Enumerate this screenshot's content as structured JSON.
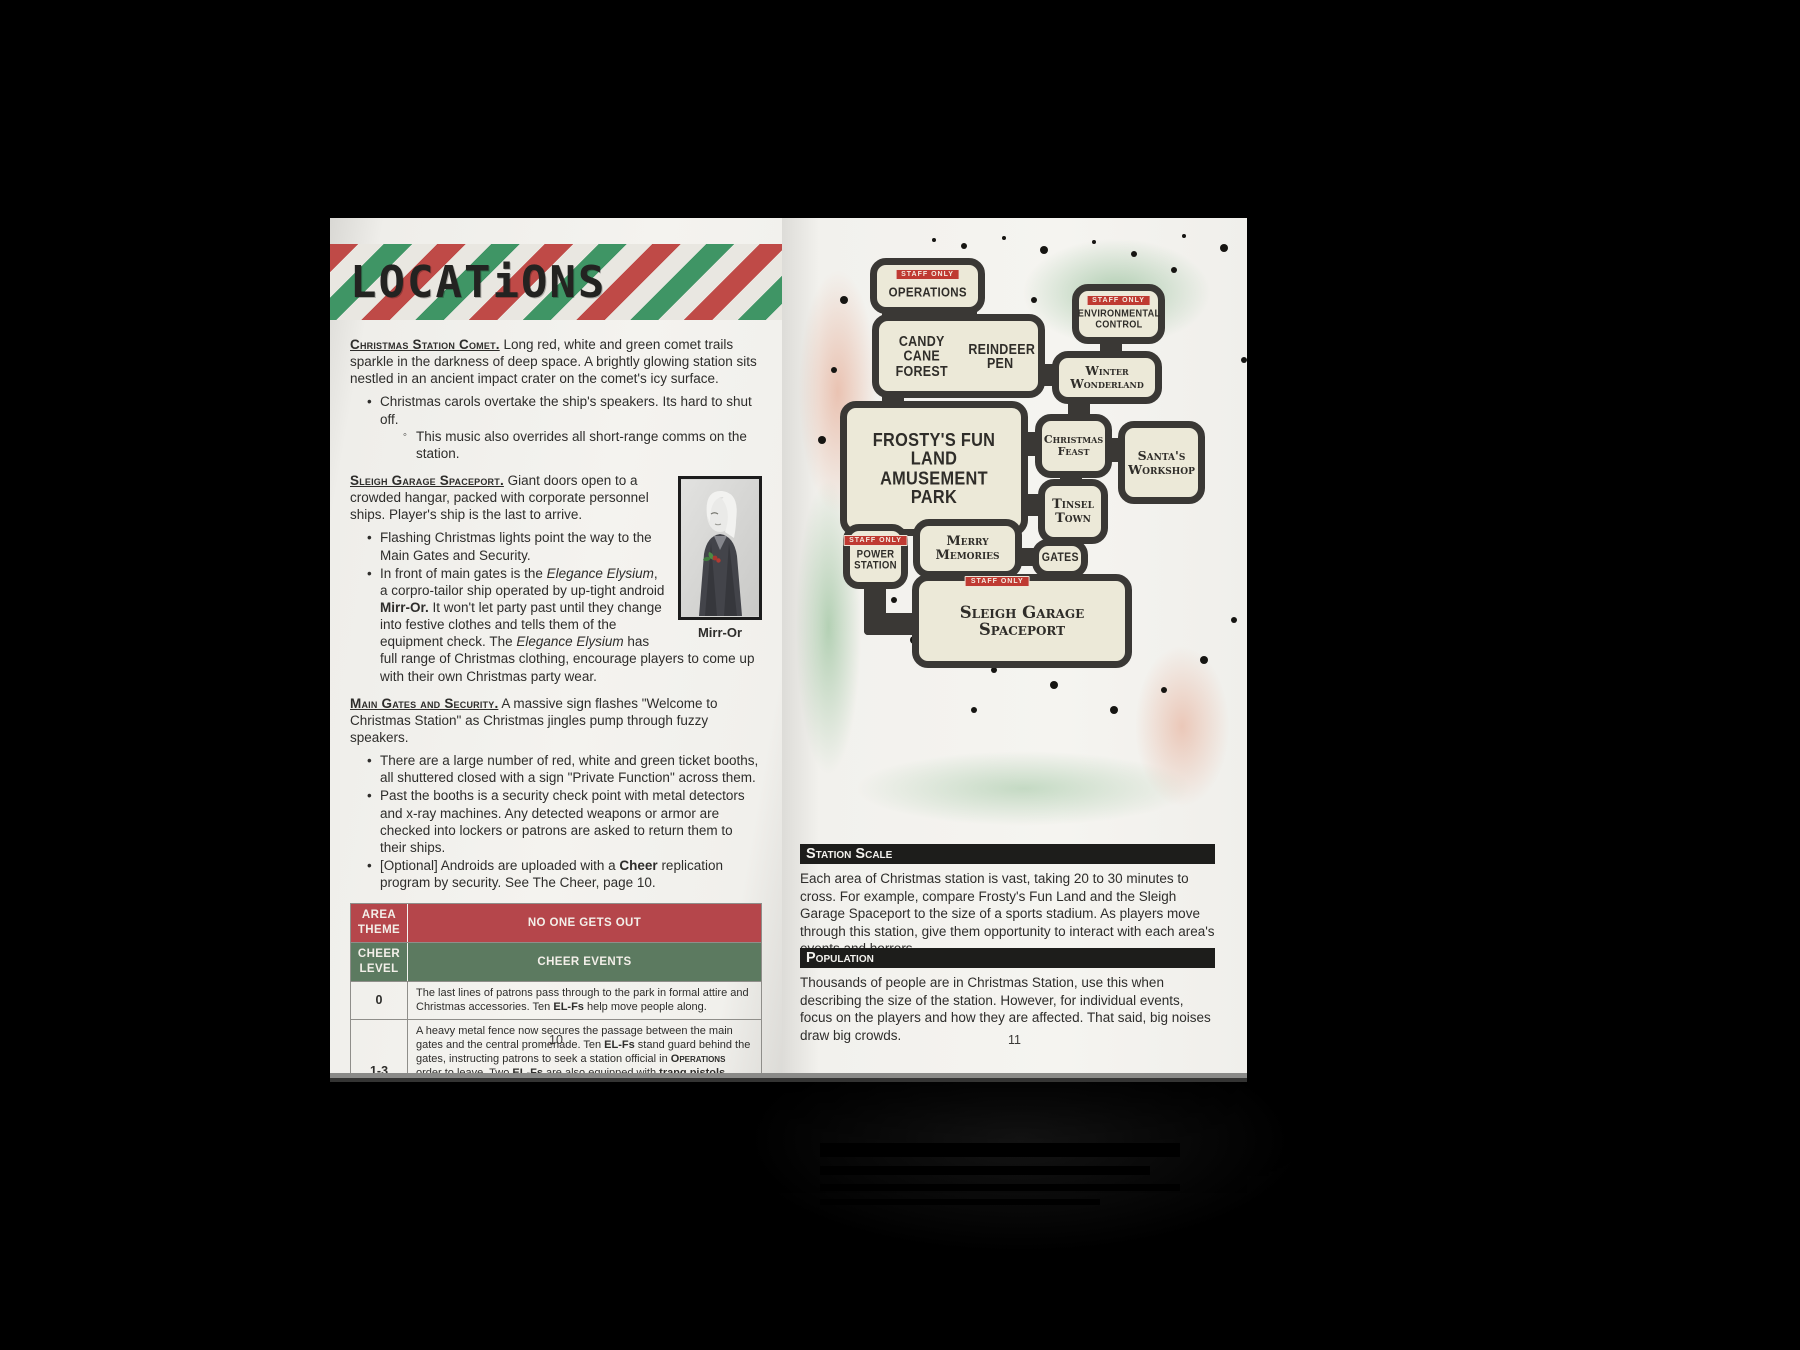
{
  "book": {
    "left_page": {
      "page_number": "10",
      "header_title": "LOCATiONS",
      "comet": {
        "title": "Christmas Station Comet.",
        "lead": " Long red, white and green comet trails sparkle in the darkness of deep space.  A brightly glowing station sits nestled in an ancient impact crater on the comet's icy surface.",
        "bullet1": "Christmas carols overtake the ship's speakers. Its hard to shut off.",
        "sub1": "This music also overrides all short-range comms on the station."
      },
      "spaceport": {
        "title": "Sleigh Garage Spaceport.",
        "lead": " Giant doors open to a crowded hangar, packed with corporate personnel ships. Player's ship is the last to arrive.",
        "bullet1": "Flashing Christmas lights point the way to the Main Gates and Security.",
        "bullet2_segments": [
          {
            "t": "In front of main gates is the "
          },
          {
            "t": "Elegance Elysium",
            "s": "i"
          },
          {
            "t": ", a corpro-tailor ship operated by up-tight android "
          },
          {
            "t": "Mirr-Or.",
            "s": "b"
          },
          {
            "t": " It won't let party past until they change into festive clothes and tells them of the equipment check. The "
          },
          {
            "t": "Elegance Elysium",
            "s": "i"
          },
          {
            "t": " has full range of Christmas clothing, encourage players to come up with their own Christmas party wear."
          }
        ],
        "portrait_caption": "Mirr-Or"
      },
      "gates": {
        "title": "Main Gates and Security.",
        "lead": "  A massive sign flashes \"Welcome to Christmas Station\" as Christmas jingles pump through fuzzy speakers.",
        "bullet1": "There are a large number of red, white and green ticket booths, all shuttered closed with a sign \"Private Function\" across them.",
        "bullet2": "Past the booths is a security check point with metal detectors and x-ray machines.  Any detected weapons or armor are checked into lockers or patrons are asked to return them to their ships.",
        "bullet3_segments": [
          {
            "t": "[Optional] Androids are uploaded with a "
          },
          {
            "t": "Cheer",
            "s": "b"
          },
          {
            "t": " replication program by security. See The Cheer, page 10."
          }
        ]
      },
      "table": {
        "header1_left": "AREA THEME",
        "header1_right": "NO ONE GETS OUT",
        "header2_left": "CHEER LEVEL",
        "header2_right": "CHEER EVENTS",
        "rows": [
          {
            "level": "0",
            "segments": [
              {
                "t": "The last lines of patrons pass through to the park in formal attire and Christmas accessories. Ten "
              },
              {
                "t": "EL-Fs",
                "s": "b"
              },
              {
                "t": " help move people along."
              }
            ]
          },
          {
            "level": "1-3",
            "segments": [
              {
                "t": "A heavy metal fence now secures the passage between the main gates and the central promenade. Ten "
              },
              {
                "t": "EL-Fs",
                "s": "b"
              },
              {
                "t": " stand guard behind the gates, instructing patrons to seek a station official in "
              },
              {
                "t": "Operations",
                "s": "sc"
              },
              {
                "t": " order to leave. Two "
              },
              {
                "t": "EL-Fs",
                "s": "b"
              },
              {
                "t": " are also equipped with "
              },
              {
                "t": "tranq pistols",
                "s": "b"
              },
              {
                "t": "."
              }
            ],
            "note_label": "Warden Note:",
            "note_segments": [
              {
                "t": " Few patrons will try to escape, as they are either affected by the Cheer or unable get past the events in "
              },
              {
                "t": "Tinsel Town",
                "s": "sc"
              },
              {
                "t": "."
              }
            ]
          }
        ]
      }
    },
    "right_page": {
      "page_number": "11",
      "map": {
        "staff_only": "STAFF ONLY",
        "areas": {
          "operations": "Operations",
          "environmental_control": "Environmental Control",
          "candy_cane_forest": "Candy Cane Forest",
          "reindeer_pen": "Reindeer Pen",
          "winter_wonderland": "Winter Wonderland",
          "frostys": "Frosty's Fun Land Amusement Park",
          "christmas_feast": "Christmas Feast",
          "santas_workshop": "Santa's Workshop",
          "tinsel_town": "Tinsel Town",
          "power_station": "Power Station",
          "merry_memories": "Merry Memories",
          "gates": "Gates",
          "sleigh_garage": "Sleigh Garage Spaceport"
        }
      },
      "station_scale": {
        "title": "Station Scale",
        "body": "Each area of Christmas station is vast, taking 20 to 30 minutes to cross. For example, compare Frosty's Fun Land and the Sleigh Garage Spaceport to the size of a sports stadium.  As players move through this station, give them opportunity to interact with each area's events and horrors."
      },
      "population": {
        "title": "Population",
        "body": "Thousands of people are in Christmas Station, use this when describing the size of the station. However, for individual events, focus on the players and how they are affected. That said, big noises draw big crowds."
      }
    }
  },
  "colors": {
    "banner_red": "#bf4a47",
    "banner_green": "#3f9565",
    "table_header_red": "#b5464b",
    "table_header_green": "#5c7a60",
    "badge_red": "#bf3a32",
    "map_box_fill": "#ece9d8",
    "map_outline": "#3a3835",
    "section_bar": "#1d1d1b"
  }
}
